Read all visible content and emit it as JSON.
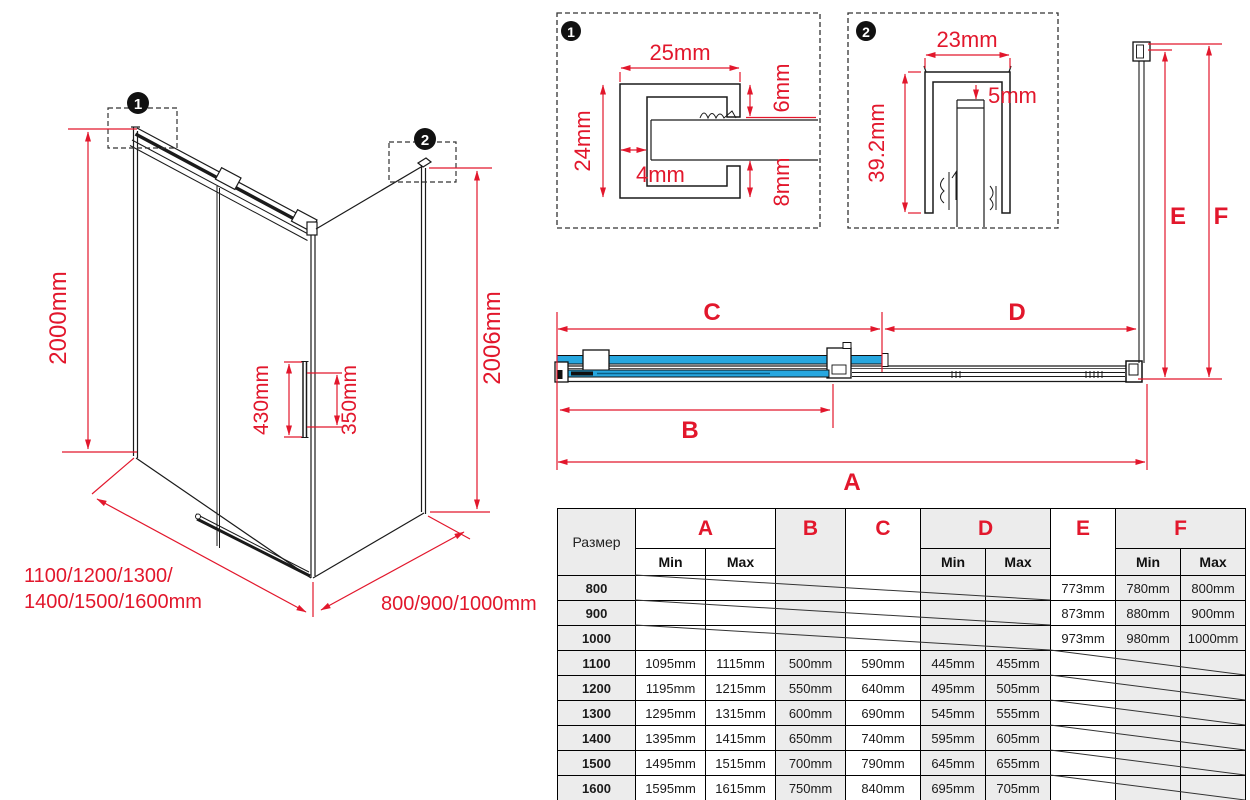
{
  "colors": {
    "red": "#E2172C",
    "blue": "#27A7DF",
    "line": "#1a1a1a",
    "table_gray": "#ECECEC"
  },
  "iso": {
    "callout1": "1",
    "callout2": "2",
    "dim_height_left": "2000mm",
    "dim_height_right": "2006mm",
    "dim_handle_total": "430mm",
    "dim_handle_holes": "350mm",
    "dim_width_line1": "1100/1200/1300/",
    "dim_width_line2": "1400/1500/1600mm",
    "dim_depth": "800/900/1000mm"
  },
  "detail1": {
    "badge": "1",
    "dim_width": "25mm",
    "dim_height": "24mm",
    "dim_wall": "4mm",
    "dim_top": "6mm",
    "dim_bottom": "8mm"
  },
  "detail2": {
    "badge": "2",
    "dim_width": "23mm",
    "dim_gap": "5mm",
    "dim_height": "39.2mm"
  },
  "plan": {
    "dim_a": "A",
    "dim_b": "B",
    "dim_c": "C",
    "dim_d": "D",
    "dim_e": "E",
    "dim_f": "F"
  },
  "table": {
    "size_header": "Размер",
    "col_a": "A",
    "col_b": "B",
    "col_c": "C",
    "col_d": "D",
    "col_e": "E",
    "col_f": "F",
    "min": "Min",
    "max": "Max",
    "rows": [
      {
        "size": "800",
        "a_min": "",
        "a_max": "",
        "b": "",
        "c": "",
        "d_min": "",
        "d_max": "",
        "e": "773mm",
        "f_min": "780mm",
        "f_max": "800mm"
      },
      {
        "size": "900",
        "a_min": "",
        "a_max": "",
        "b": "",
        "c": "",
        "d_min": "",
        "d_max": "",
        "e": "873mm",
        "f_min": "880mm",
        "f_max": "900mm"
      },
      {
        "size": "1000",
        "a_min": "",
        "a_max": "",
        "b": "",
        "c": "",
        "d_min": "",
        "d_max": "",
        "e": "973mm",
        "f_min": "980mm",
        "f_max": "1000mm"
      },
      {
        "size": "1100",
        "a_min": "1095mm",
        "a_max": "1115mm",
        "b": "500mm",
        "c": "590mm",
        "d_min": "445mm",
        "d_max": "455mm",
        "e": "",
        "f_min": "",
        "f_max": ""
      },
      {
        "size": "1200",
        "a_min": "1195mm",
        "a_max": "1215mm",
        "b": "550mm",
        "c": "640mm",
        "d_min": "495mm",
        "d_max": "505mm",
        "e": "",
        "f_min": "",
        "f_max": ""
      },
      {
        "size": "1300",
        "a_min": "1295mm",
        "a_max": "1315mm",
        "b": "600mm",
        "c": "690mm",
        "d_min": "545mm",
        "d_max": "555mm",
        "e": "",
        "f_min": "",
        "f_max": ""
      },
      {
        "size": "1400",
        "a_min": "1395mm",
        "a_max": "1415mm",
        "b": "650mm",
        "c": "740mm",
        "d_min": "595mm",
        "d_max": "605mm",
        "e": "",
        "f_min": "",
        "f_max": ""
      },
      {
        "size": "1500",
        "a_min": "1495mm",
        "a_max": "1515mm",
        "b": "700mm",
        "c": "790mm",
        "d_min": "645mm",
        "d_max": "655mm",
        "e": "",
        "f_min": "",
        "f_max": ""
      },
      {
        "size": "1600",
        "a_min": "1595mm",
        "a_max": "1615mm",
        "b": "750mm",
        "c": "840mm",
        "d_min": "695mm",
        "d_max": "705mm",
        "e": "",
        "f_min": "",
        "f_max": ""
      }
    ]
  }
}
